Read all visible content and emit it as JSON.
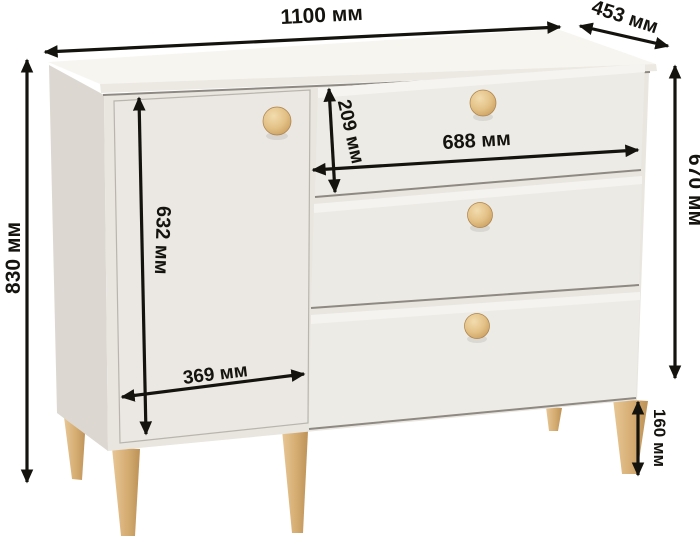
{
  "diagram": {
    "type": "furniture-dimension-diagram",
    "unit": "мм",
    "dimensions": {
      "width": "1100 мм",
      "depth": "453 мм",
      "height": "830 мм",
      "body_height": "670 мм",
      "door_height": "632 мм",
      "door_width": "369 мм",
      "drawer_width": "688 мм",
      "drawer_front_height": "209 мм",
      "leg_height": "160 мм"
    },
    "colors": {
      "dimension_ink": "#15130e",
      "top_surface": "#f7f5f0",
      "front_surface": "#e9e6e0",
      "side_surface": "#dcd8d1",
      "wood": "#d9b27c",
      "background": "#ffffff"
    }
  }
}
